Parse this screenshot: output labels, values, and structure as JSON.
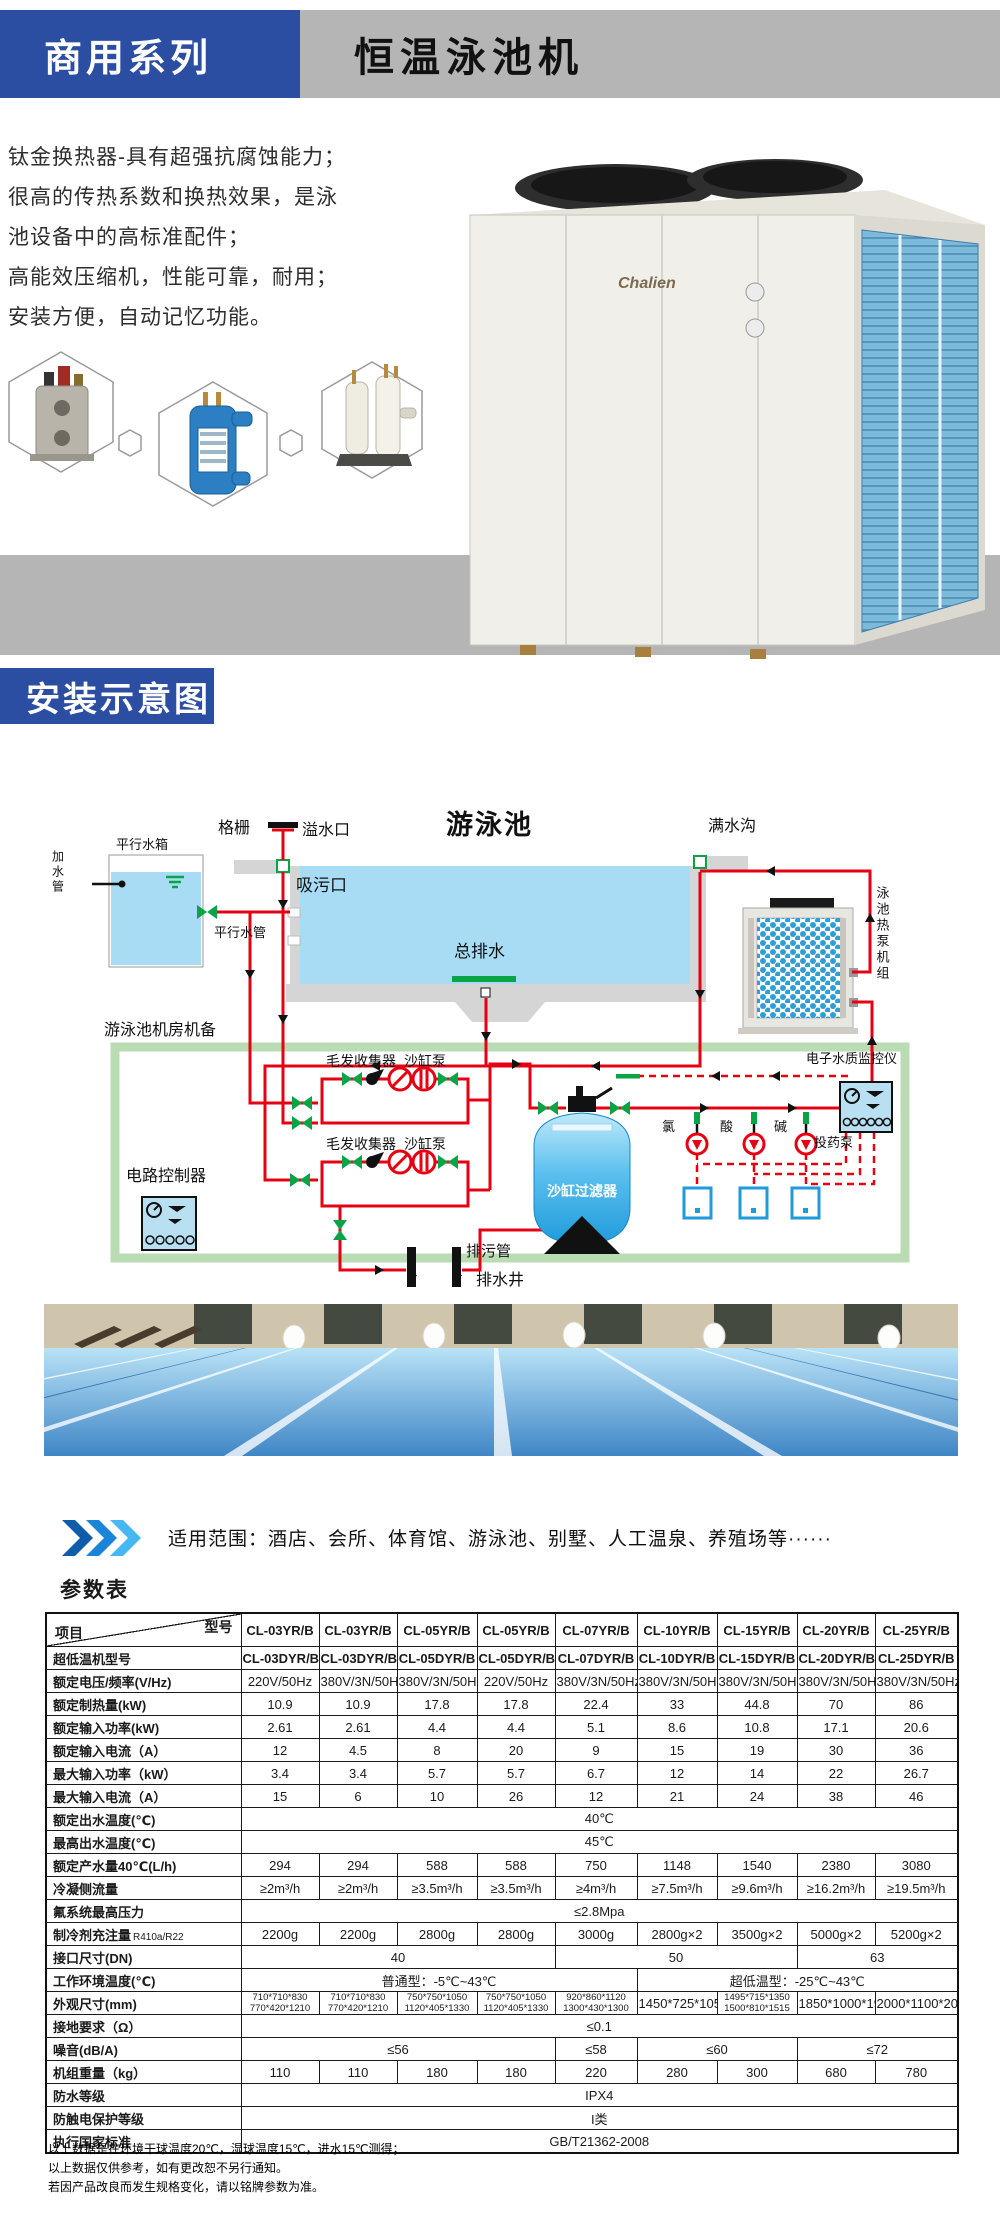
{
  "header": {
    "series_label": "商用系列",
    "product_title": "恒温泳池机"
  },
  "intro": {
    "lines": [
      "钛金换热器-具有超强抗腐蚀能力；",
      "很高的传热系数和换热效果，是泳",
      "池设备中的高标准配件；",
      "高能效压缩机，性能可靠，耐用；",
      "安装方便，自动记忆功能。"
    ]
  },
  "brand": {
    "logo_text": "Chalien"
  },
  "section2": {
    "title": "安装示意图"
  },
  "diagram": {
    "labels": {
      "parallel_tank": "平行水箱",
      "add_water_pipe": "加水管",
      "grille": "格栅",
      "overflow": "溢水口",
      "pool": "游泳池",
      "suction": "吸污口",
      "parallel_pipe": "平行水管",
      "main_drain": "总排水",
      "full_trough": "满水沟",
      "heat_pump_unit": "泳池热泵机组",
      "machine_room": "游泳池机房机备",
      "hair_collector_1": "毛发收集器",
      "sand_pump_1": "沙缸泵",
      "hair_collector_2": "毛发收集器",
      "sand_pump_2": "沙缸泵",
      "circuit_controller": "电路控制器",
      "sand_filter": "沙缸过滤器",
      "sewage_pipe": "排污管",
      "drain_well": "排水井",
      "water_monitor": "电子水质监控仪",
      "chlorine": "氯",
      "acid": "酸",
      "alkali": "碱",
      "dosing_pump": "投药泵"
    }
  },
  "scope": {
    "text": "适用范围：酒店、会所、体育馆、游泳池、别墅、人工温泉、养殖场等······"
  },
  "specs": {
    "title": "参数表",
    "diagonal": {
      "top_right": "型号",
      "bottom_left": "项目"
    },
    "models": [
      "CL-03YR/B",
      "CL-03YR/B",
      "CL-05YR/B",
      "CL-05YR/B",
      "CL-07YR/B",
      "CL-10YR/B",
      "CL-15YR/B",
      "CL-20YR/B",
      "CL-25YR/B"
    ],
    "rows": [
      {
        "label": "超低温机型号",
        "cls": "mdl",
        "cells": [
          "CL-03DYR/B",
          "CL-03DYR/B",
          "CL-05DYR/B",
          "CL-05DYR/B",
          "CL-07DYR/B",
          "CL-10DYR/B",
          "CL-15DYR/B",
          "CL-20DYR/B",
          "CL-25DYR/B"
        ]
      },
      {
        "label": "额定电压/频率(V/Hz)",
        "cls": "sm",
        "cells": [
          "220V/50Hz",
          "380V/3N/50Hz",
          "380V/3N/50Hz",
          "220V/50Hz",
          "380V/3N/50Hz",
          "380V/3N/50Hz",
          "380V/3N/50Hz",
          "380V/3N/50Hz",
          "380V/3N/50Hz"
        ]
      },
      {
        "label": "额定制热量(kW)",
        "cells": [
          "10.9",
          "10.9",
          "17.8",
          "17.8",
          "22.4",
          "33",
          "44.8",
          "70",
          "86"
        ]
      },
      {
        "label": "额定输入功率(kW)",
        "cells": [
          "2.61",
          "2.61",
          "4.4",
          "4.4",
          "5.1",
          "8.6",
          "10.8",
          "17.1",
          "20.6"
        ]
      },
      {
        "label": "额定输入电流（A）",
        "cells": [
          "12",
          "4.5",
          "8",
          "20",
          "9",
          "15",
          "19",
          "30",
          "36"
        ]
      },
      {
        "label": "最大输入功率（kW）",
        "cells": [
          "3.4",
          "3.4",
          "5.7",
          "5.7",
          "6.7",
          "12",
          "14",
          "22",
          "26.7"
        ]
      },
      {
        "label": "最大输入电流（A）",
        "cells": [
          "15",
          "6",
          "10",
          "26",
          "12",
          "21",
          "24",
          "38",
          "46"
        ]
      },
      {
        "label": "额定出水温度(℃)",
        "cells": [
          {
            "t": "40℃",
            "s": 9
          }
        ]
      },
      {
        "label": "最高出水温度(℃)",
        "cells": [
          {
            "t": "45℃",
            "s": 9
          }
        ]
      },
      {
        "label": "额定产水量40℃(L/h)",
        "cells": [
          "294",
          "294",
          "588",
          "588",
          "750",
          "1148",
          "1540",
          "2380",
          "3080"
        ]
      },
      {
        "label": "冷凝侧流量",
        "cls": "sm2",
        "cells": [
          "≥2m³/h",
          "≥2m³/h",
          "≥3.5m³/h",
          "≥3.5m³/h",
          "≥4m³/h",
          "≥7.5m³/h",
          "≥9.6m³/h",
          "≥16.2m³/h",
          "≥19.5m³/h"
        ]
      },
      {
        "label": "氟系统最高压力",
        "cells": [
          {
            "t": "≤2.8Mpa",
            "s": 9
          }
        ]
      },
      {
        "label": "制冷剂充注量",
        "label_sub": "R410a/R22",
        "cells": [
          "2200g",
          "2200g",
          "2800g",
          "2800g",
          "3000g",
          "2800g×2",
          "3500g×2",
          "5000g×2",
          "5200g×2"
        ]
      },
      {
        "label": "接口尺寸(DN)",
        "cells": [
          {
            "t": "40",
            "s": 4
          },
          {
            "t": "50",
            "s": 3
          },
          {
            "t": "63",
            "s": 2
          }
        ]
      },
      {
        "label": "工作环境温度(℃)",
        "cells": [
          {
            "t": "普通型：-5℃~43℃",
            "s": 5
          },
          {
            "t": "超低温型：-25℃~43℃",
            "s": 4
          }
        ]
      },
      {
        "label": "外观尺寸(mm)",
        "cls": "dims",
        "cells": [
          {
            "t": "710*710*830\n770*420*1210",
            "c": "two"
          },
          {
            "t": "710*710*830\n770*420*1210",
            "c": "two"
          },
          {
            "t": "750*750*1050\n1120*405*1330",
            "c": "two"
          },
          {
            "t": "750*750*1050\n1120*405*1330",
            "c": "two"
          },
          {
            "t": "920*860*1120\n1300*430*1300",
            "c": "two"
          },
          "1450*725*1050",
          {
            "t": "1495*715*1350\n1500*810*1515",
            "c": "two"
          },
          "1850*1000*1950",
          "2000*1100*2080"
        ]
      },
      {
        "label": "接地要求（Ω）",
        "cells": [
          {
            "t": "≤0.1",
            "s": 9
          }
        ]
      },
      {
        "label": "噪音(dB/A)",
        "cells": [
          {
            "t": "≤56",
            "s": 4
          },
          "≤58",
          {
            "t": "≤60",
            "s": 2
          },
          {
            "t": "≤72",
            "s": 2
          }
        ]
      },
      {
        "label": "机组重量（kg）",
        "cells": [
          "110",
          "110",
          "180",
          "180",
          "220",
          "280",
          "300",
          "680",
          "780"
        ]
      },
      {
        "label": "防水等级",
        "cells": [
          {
            "t": "IPX4",
            "s": 9
          }
        ]
      },
      {
        "label": "防触电保护等级",
        "cells": [
          {
            "t": "I类",
            "s": 9
          }
        ]
      },
      {
        "label": "执行国家标准",
        "cells": [
          {
            "t": "GB/T21362-2008",
            "s": 9
          }
        ]
      }
    ],
    "notes": [
      "以上数据是在环境干球温度20℃，湿球温度15℃，进水15℃测得；",
      "以上数据仅供参考，如有更改恕不另行通知。",
      "若因产品改良而发生规格变化，请以铭牌参数为准。"
    ]
  }
}
